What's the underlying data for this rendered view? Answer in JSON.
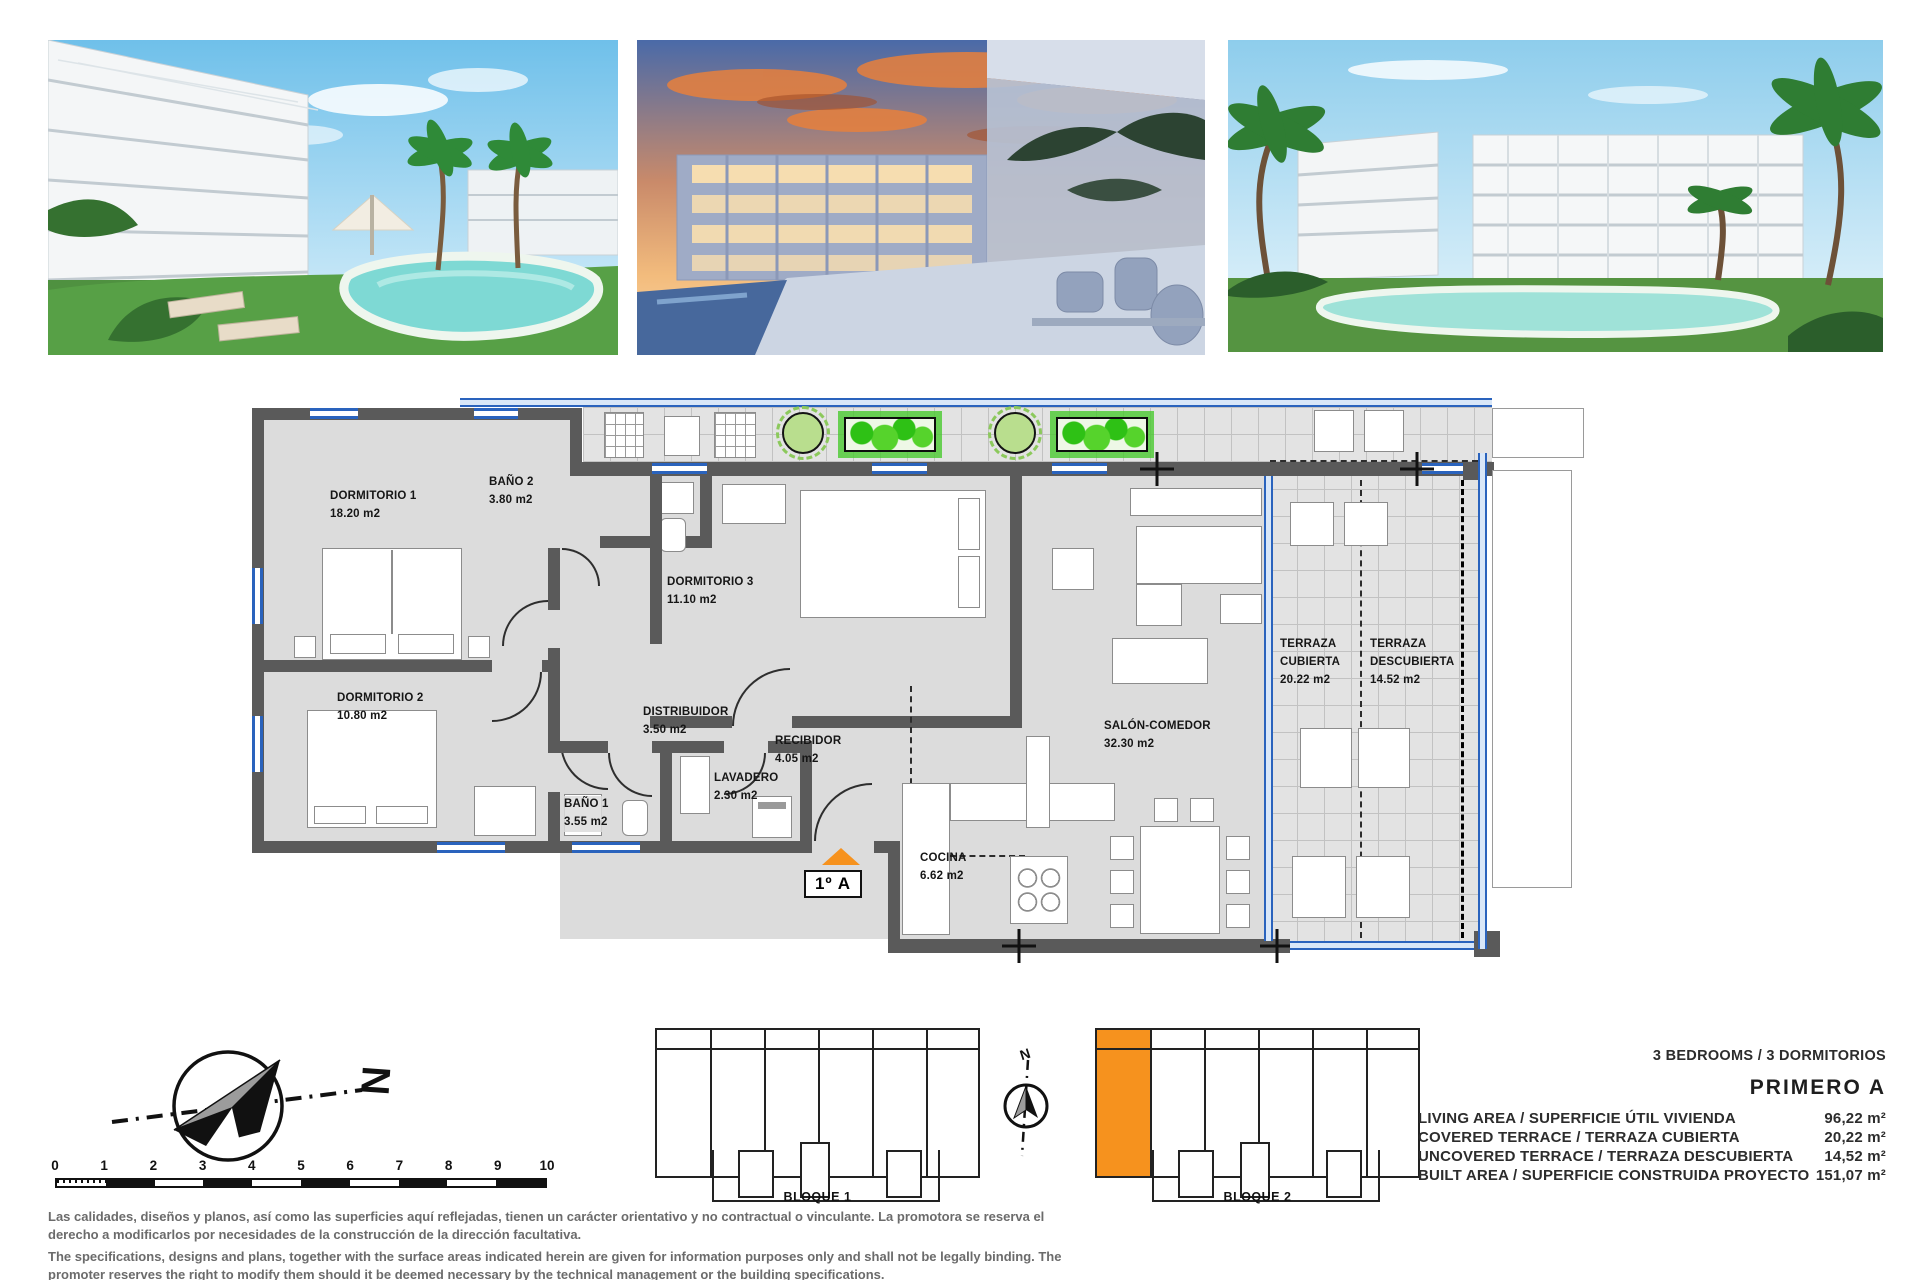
{
  "photos": [
    {
      "alt": "pool-garden-day-render"
    },
    {
      "alt": "terrace-dusk-render"
    },
    {
      "alt": "buildings-pool-day-render"
    }
  ],
  "floorplan": {
    "unit_label": "1º A",
    "rooms": [
      {
        "name": "DORMITORIO 1",
        "area": "18.20 m2"
      },
      {
        "name": "BAÑO 2",
        "area": "3.80 m2"
      },
      {
        "name": "DORMITORIO 3",
        "area": "11.10 m2"
      },
      {
        "name": "DORMITORIO 2",
        "area": "10.80 m2"
      },
      {
        "name": "DISTRIBUIDOR",
        "area": "3.50 m2"
      },
      {
        "name": "BAÑO 1",
        "area": "3.55 m2"
      },
      {
        "name": "LAVADERO",
        "area": "2.30 m2"
      },
      {
        "name": "RECIBIDOR",
        "area": "4.05 m2"
      },
      {
        "name": "SALÓN-COMEDOR",
        "area": "32.30 m2"
      },
      {
        "name": "COCINA",
        "area": "6.62 m2"
      },
      {
        "name": "TERRAZA",
        "name2": "CUBIERTA",
        "area": "20.22 m2"
      },
      {
        "name": "TERRAZA",
        "name2": "DESCUBIERTA",
        "area": "14.52 m2"
      }
    ]
  },
  "compass": {
    "north_label": "N"
  },
  "scalebar": {
    "ticks": [
      "0",
      "1",
      "2",
      "3",
      "4",
      "5",
      "6",
      "7",
      "8",
      "9",
      "10"
    ]
  },
  "blocks": [
    {
      "label": "BLOQUE 1"
    },
    {
      "label": "BLOQUE 2"
    }
  ],
  "specs": {
    "bedrooms_line": "3 BEDROOMS / 3 DORMITORIOS",
    "unit_title": "PRIMERO A",
    "rows": [
      {
        "label": "LIVING AREA / SUPERFICIE ÚTIL VIVIENDA",
        "value": "96,22 m²"
      },
      {
        "label": "COVERED TERRACE / TERRAZA CUBIERTA",
        "value": "20,22 m²"
      },
      {
        "label": "UNCOVERED TERRACE / TERRAZA DESCUBIERTA",
        "value": "14,52 m²"
      },
      {
        "label": "BUILT AREA / SUPERFICIE CONSTRUIDA PROYECTO",
        "value": "151,07 m²"
      }
    ]
  },
  "disclaimer": {
    "es": "Las calidades, diseños y planos, así como las superficies aquí reflejadas, tienen un carácter orientativo y no contractual o vinculante. La promotora se reserva el derecho a modificarlos por necesidades de la construcción de la dirección facultativa.",
    "en": "The specifications, designs and plans, together with the surface areas indicated herein are given for information purposes only and shall not be legally binding. The promoter reserves the right to modify them should it be deemed necessary by the technical management or the building specifications."
  },
  "colors": {
    "accent_orange": "#F6921E",
    "window_blue": "#2A63BD",
    "wall_gray": "#5A5A5A",
    "plant_green": "#3FBF2F"
  }
}
